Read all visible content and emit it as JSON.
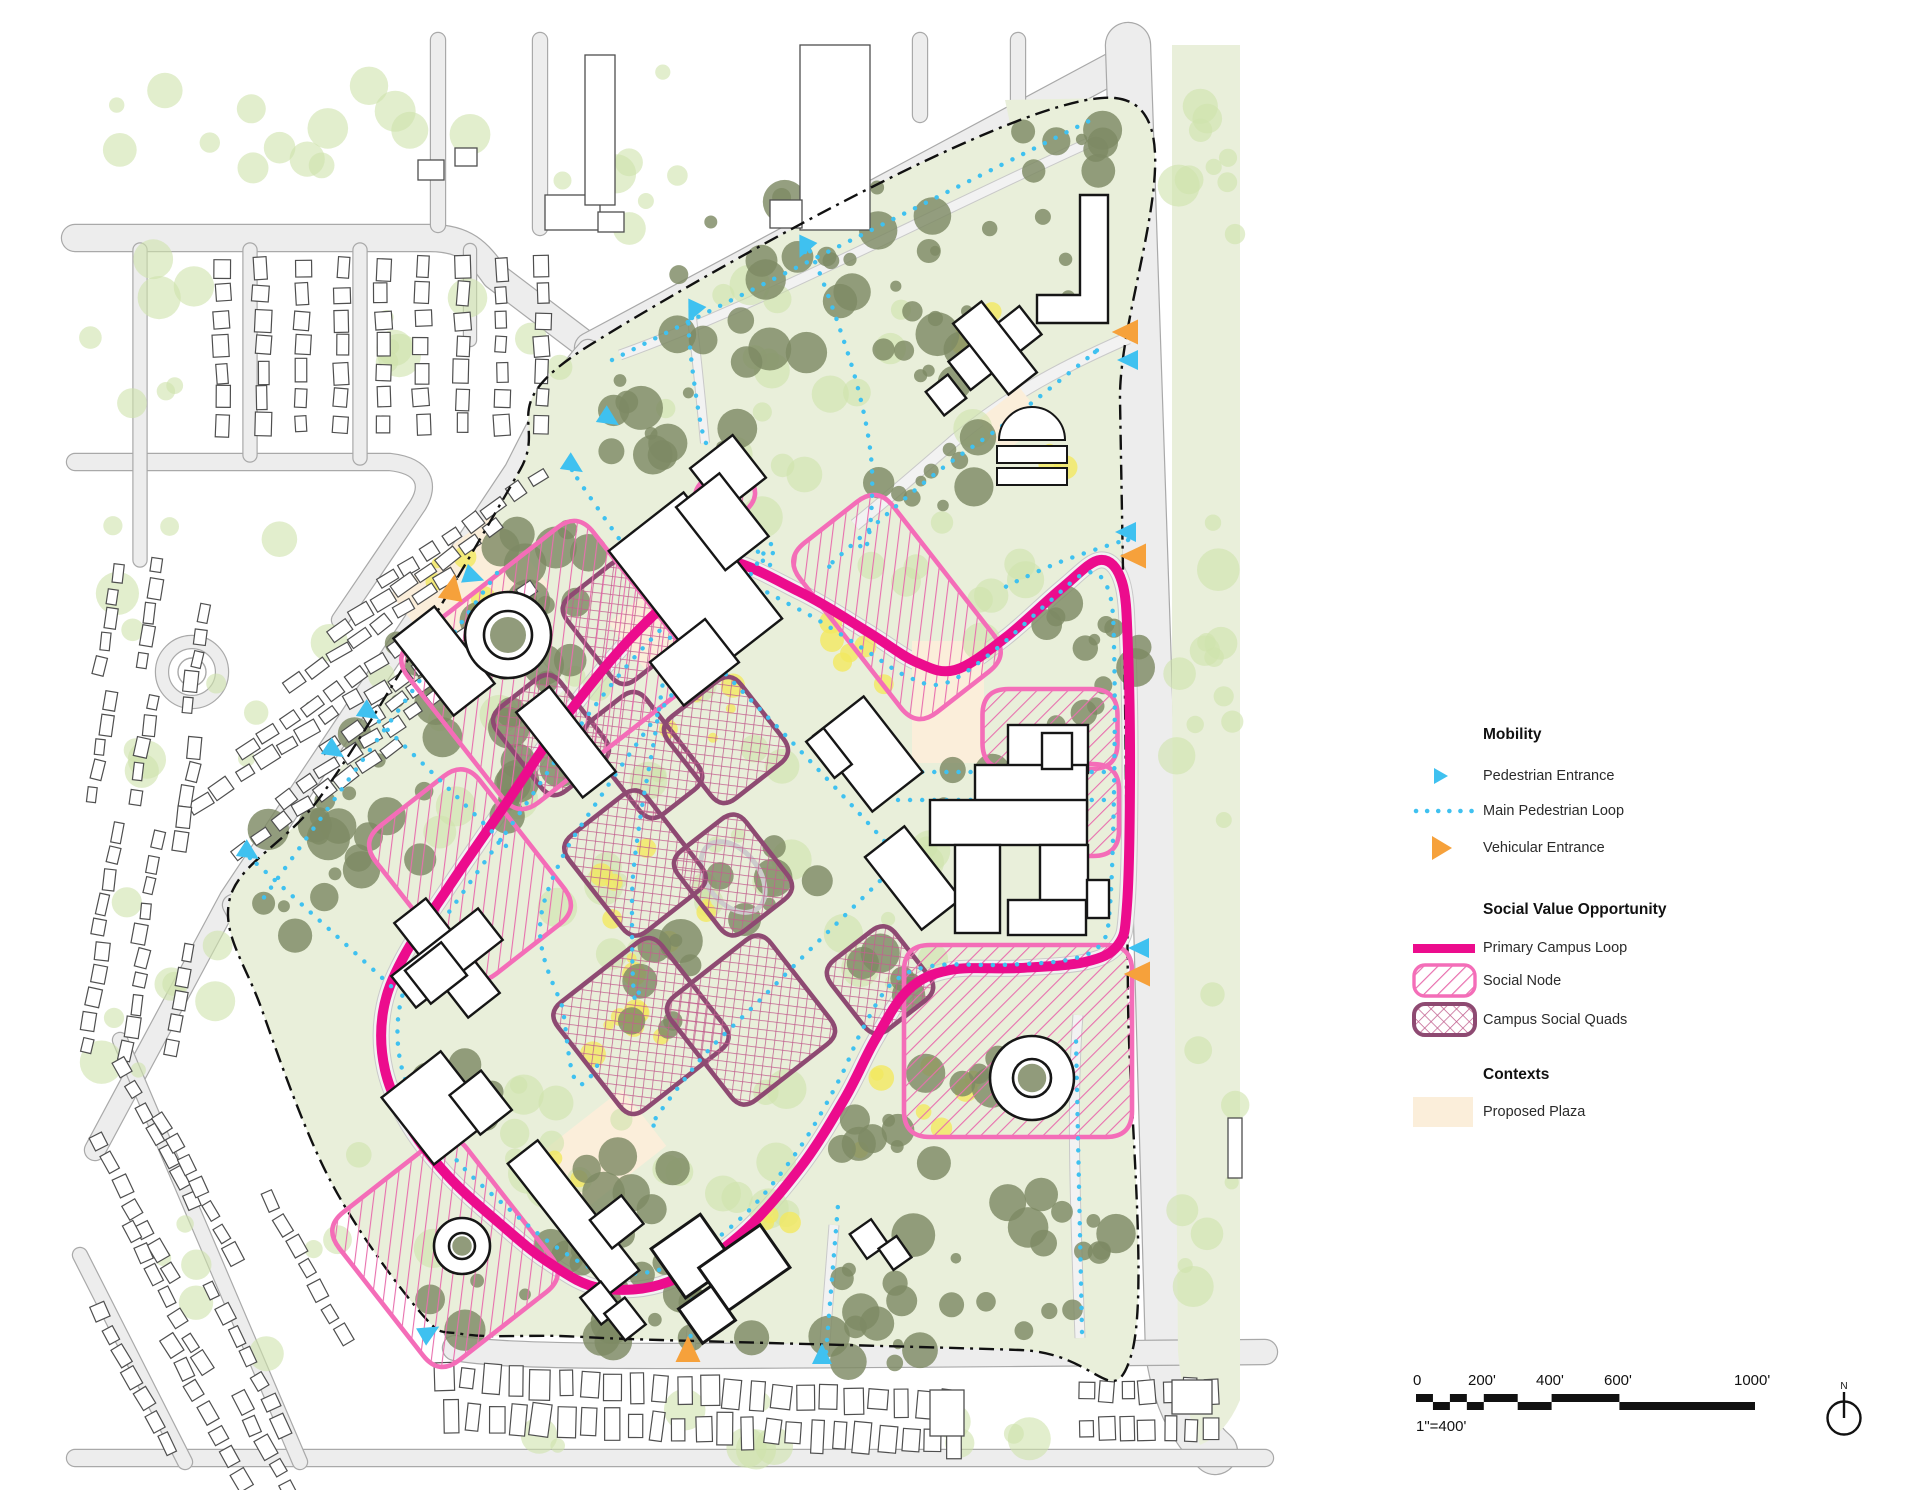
{
  "legend": {
    "mobility": {
      "title": "Mobility",
      "items": [
        {
          "id": "pedestrian-entrance",
          "label": "Pedestrian Entrance"
        },
        {
          "id": "main-pedestrian-loop",
          "label": "Main Pedestrian Loop"
        },
        {
          "id": "vehicular-entrance",
          "label": "Vehicular Entrance"
        }
      ]
    },
    "social_value": {
      "title": "Social Value Opportunity",
      "items": [
        {
          "id": "primary-campus-loop",
          "label": "Primary Campus Loop"
        },
        {
          "id": "social-node",
          "label": "Social Node"
        },
        {
          "id": "campus-social-quads",
          "label": "Campus Social Quads"
        }
      ]
    },
    "contexts": {
      "title": "Contexts",
      "items": [
        {
          "id": "proposed-plaza",
          "label": "Proposed Plaza"
        }
      ]
    }
  },
  "scale_bar": {
    "tick_labels": [
      "0",
      "200'",
      "400'",
      "600'",
      "1000'"
    ],
    "tick_feet": [
      0,
      200,
      400,
      600,
      1000
    ],
    "scale_note": "1\"=400'",
    "north_label": "N"
  },
  "map": {
    "colors": {
      "primary_loop": "#EC0C8D",
      "social_node_pink": "#F46DB8",
      "quad_maroon": "#8E4A72",
      "hatch_pink": "#E86FAE",
      "pedestrian_cyan": "#3FC1F0",
      "vehicular_orange": "#F6A13B",
      "campus_green": "#E9EFDA",
      "olive_tree": "#7E8A64",
      "light_tree": "#CFE2AC",
      "yellow_accent": "#F2E860",
      "proposed_plaza": "#FBEEDA",
      "road_gray": "#EDEDED",
      "boundary_black": "#111111"
    }
  }
}
